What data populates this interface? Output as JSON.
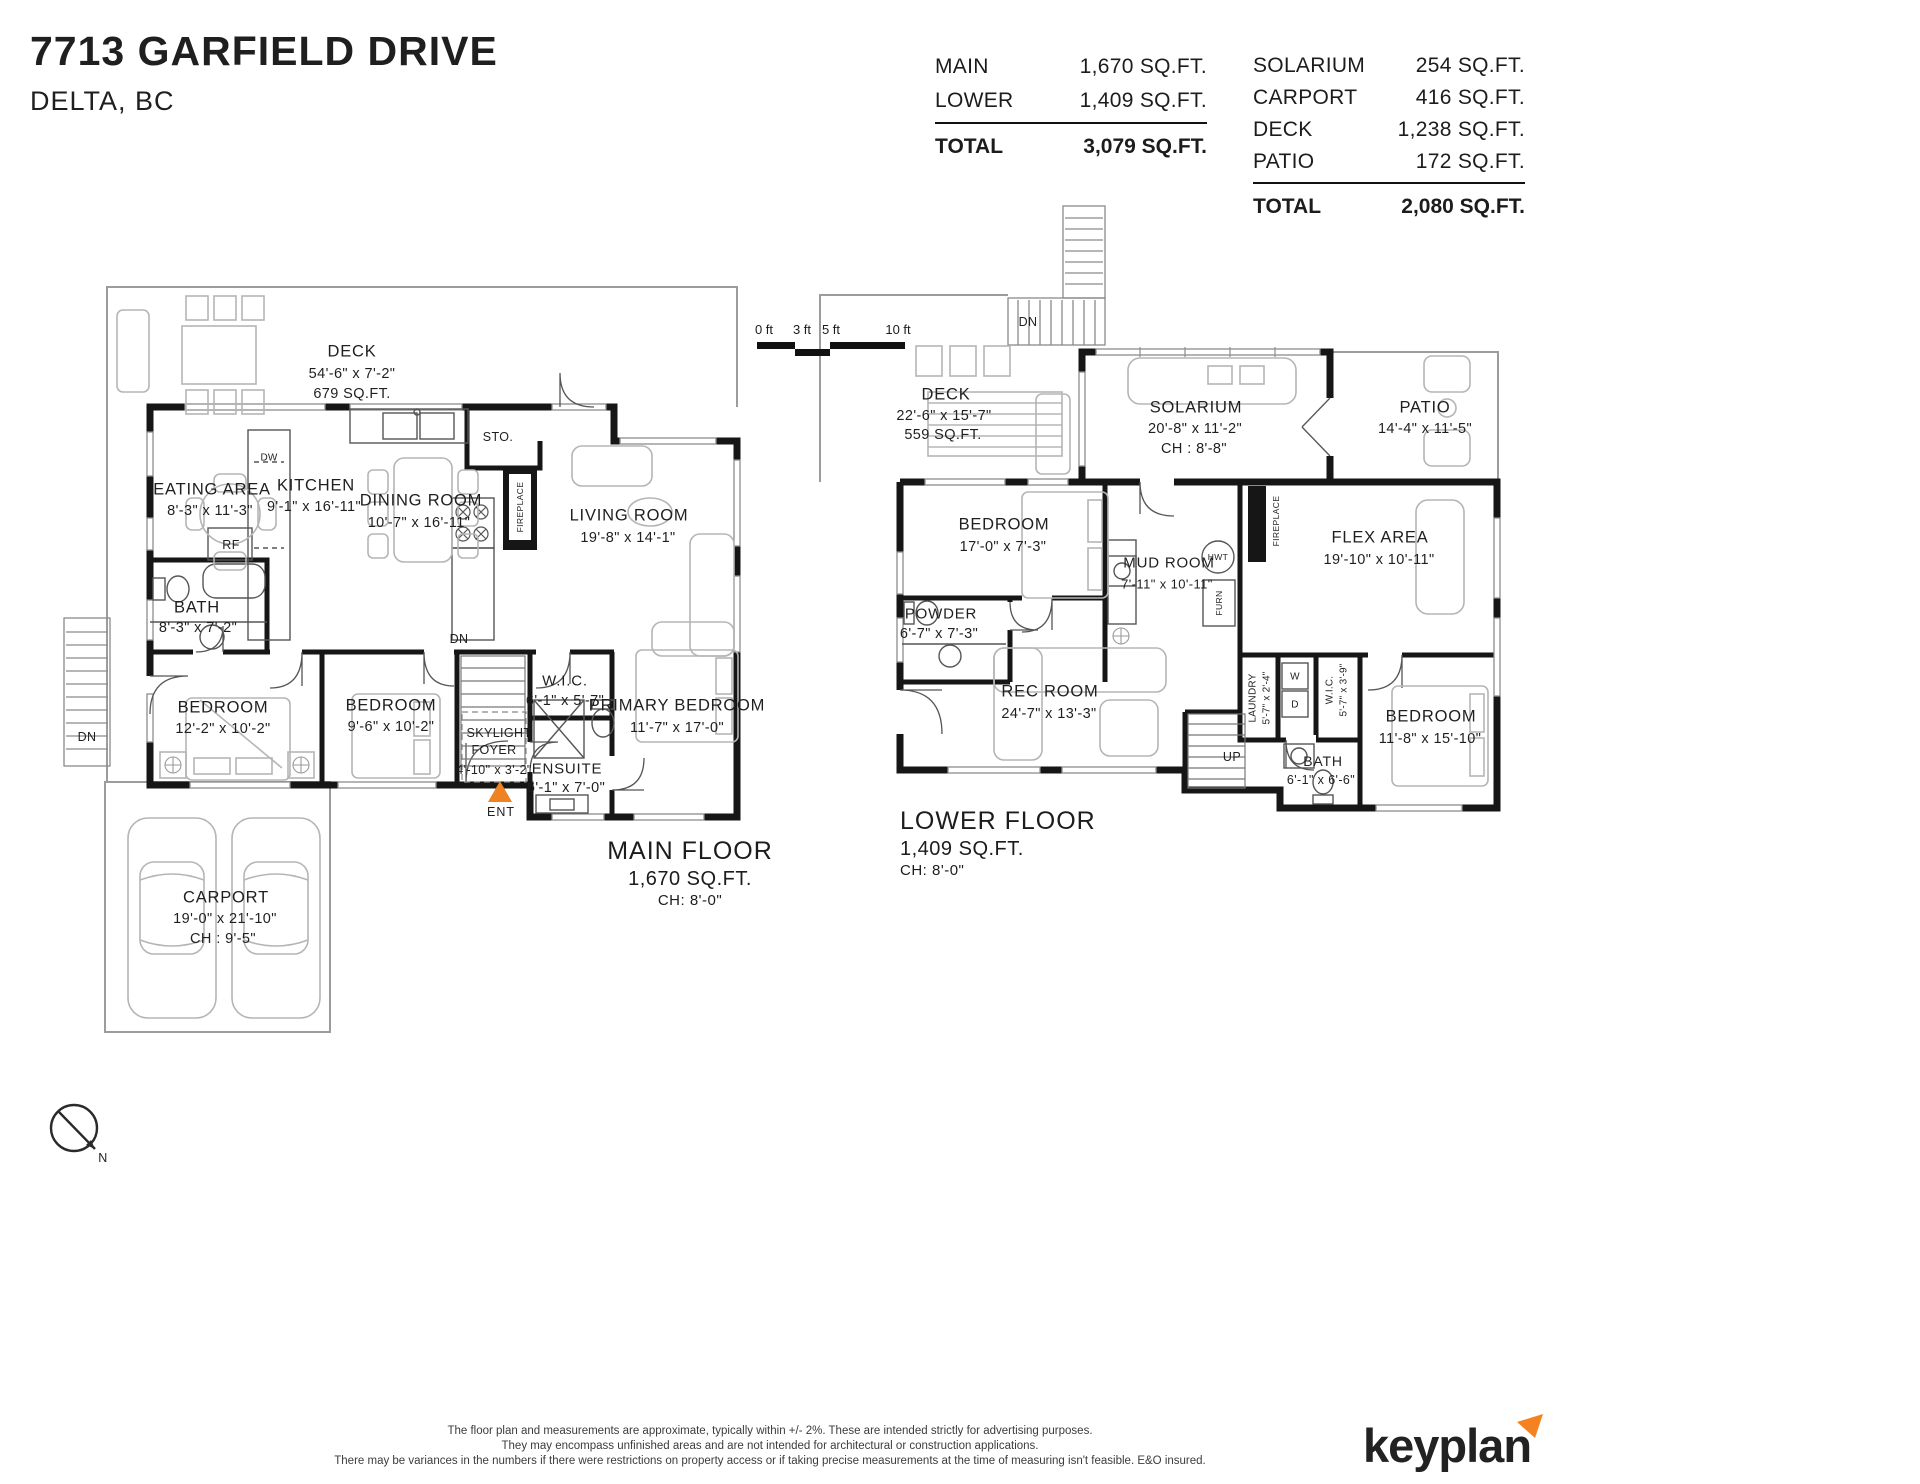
{
  "header": {
    "title": "7713 GARFIELD DRIVE",
    "subtitle": "DELTA, BC",
    "floor_table": {
      "rows": [
        {
          "label": "MAIN",
          "value": "1,670 SQ.FT."
        },
        {
          "label": "LOWER",
          "value": "1,409 SQ.FT."
        }
      ],
      "total": {
        "label": "TOTAL",
        "value": "3,079 SQ.FT."
      }
    },
    "outdoor_table": {
      "rows": [
        {
          "label": "SOLARIUM",
          "value": "254 SQ.FT."
        },
        {
          "label": "CARPORT",
          "value": "416 SQ.FT."
        },
        {
          "label": "DECK",
          "value": "1,238 SQ.FT."
        },
        {
          "label": "PATIO",
          "value": "172 SQ.FT."
        }
      ],
      "total": {
        "label": "TOTAL",
        "value": "2,080 SQ.FT."
      }
    }
  },
  "scale_bar": {
    "labels": [
      "0 ft",
      "3 ft",
      "5 ft",
      "10 ft"
    ]
  },
  "main_floor": {
    "rooms": {
      "deck": {
        "name": "DECK",
        "dims": "54'-6\"  x   7'-2\"",
        "area": "679 SQ.FT."
      },
      "eating": {
        "name": "EATING AREA",
        "dims": "8'-3\"   x   11'-3\""
      },
      "kitchen": {
        "name": "KITCHEN",
        "dims": "9'-1\"  x 16'-11\""
      },
      "dining": {
        "name": "DINING ROOM",
        "dims": "10'-7\"  x  16'-11\""
      },
      "living": {
        "name": "LIVING ROOM",
        "dims": "19'-8\"  x  14'-1\""
      },
      "bath": {
        "name": "BATH",
        "dims": "8'-3\"   x   7'-2\""
      },
      "bedroom1": {
        "name": "BEDROOM",
        "dims": "12'-2\"  x  10'-2\""
      },
      "bedroom2": {
        "name": "BEDROOM",
        "dims": "9'-6\"  x  10'-2\""
      },
      "wic": {
        "name": "W.I.C.",
        "dims": "6'-1\"  x  5'-7\""
      },
      "foyer": {
        "name_line1": "SKYLIGHT",
        "name_line2": "FOYER",
        "dims": "4'-10\" x  3'-2\""
      },
      "ensuite": {
        "name": "ENSUITE",
        "dims": "6'-1\" x 7'-0\""
      },
      "primary": {
        "name": "PRIMARY BEDROOM",
        "dims": "11'-7\"   x   17'-0\""
      },
      "carport": {
        "name": "CARPORT",
        "dims": "19'-0\"  x  21'-10\"",
        "ch": "CH : 9'-5\""
      }
    },
    "labels": {
      "sto": "STO.",
      "fireplace": "FIREPLACE",
      "dw": "DW",
      "rf": "RF",
      "dn_stairs": "DN",
      "dn_deck": "DN",
      "ent": "ENT"
    },
    "floor_label": {
      "name": "MAIN FLOOR",
      "area": "1,670 SQ.FT.",
      "ch": "CH: 8'-0\""
    }
  },
  "lower_floor": {
    "rooms": {
      "deck": {
        "name": "DECK",
        "dims": "22'-6\"  x  15'-7\"",
        "area": "559 SQ.FT."
      },
      "solarium": {
        "name": "SOLARIUM",
        "dims": "20'-8\"  x   11'-2\"",
        "ch": "CH : 8'-8\""
      },
      "patio": {
        "name": "PATIO",
        "dims": "14'-4\"  x  11'-5\""
      },
      "bedroom_l": {
        "name": "BEDROOM",
        "dims": "17'-0\"  x   7'-3\""
      },
      "powder": {
        "name": "POWDER",
        "dims": "6'-7\"  x   7'-3\""
      },
      "mudroom": {
        "name": "MUD ROOM",
        "dims": "7'-11\" x 10'-11\""
      },
      "flex": {
        "name": "FLEX AREA",
        "dims": "19'-10\"  x  10'-11\""
      },
      "rec": {
        "name": "REC ROOM",
        "dims": "24'-7\"  x  13'-3\""
      },
      "laundry": {
        "name": "LAUNDRY",
        "dims": "5'-7\"  x  2'-4\""
      },
      "wic": {
        "name": "W.I.C.",
        "dims": "5'-7\" x 3'-9\""
      },
      "bedroom_r": {
        "name": "BEDROOM",
        "dims": "11'-8\"  x  15'-10\""
      },
      "bath": {
        "name": "BATH",
        "dims": "6'-1\" x 6'-6\""
      }
    },
    "labels": {
      "dn": "DN",
      "up": "UP",
      "hwt": "HWT",
      "furn": "FURN",
      "fireplace": "FIREPLACE",
      "washer": "W",
      "dryer": "D"
    },
    "floor_label": {
      "name": "LOWER FLOOR",
      "area": "1,409 SQ.FT.",
      "ch": "CH: 8'-0\""
    }
  },
  "compass": {
    "label": "N"
  },
  "footer": {
    "disclaimer_lines": [
      "The floor plan and measurements are approximate, typically within +/- 2%. These are intended strictly for advertising purposes.",
      "They may encompass unfinished areas and are not intended for architectural or construction applications.",
      "There may be variances in the numbers if there were restrictions on property access or if taking precise measurements at the time of measuring isn't feasible. E&O insured."
    ],
    "brand": "keyplan"
  }
}
